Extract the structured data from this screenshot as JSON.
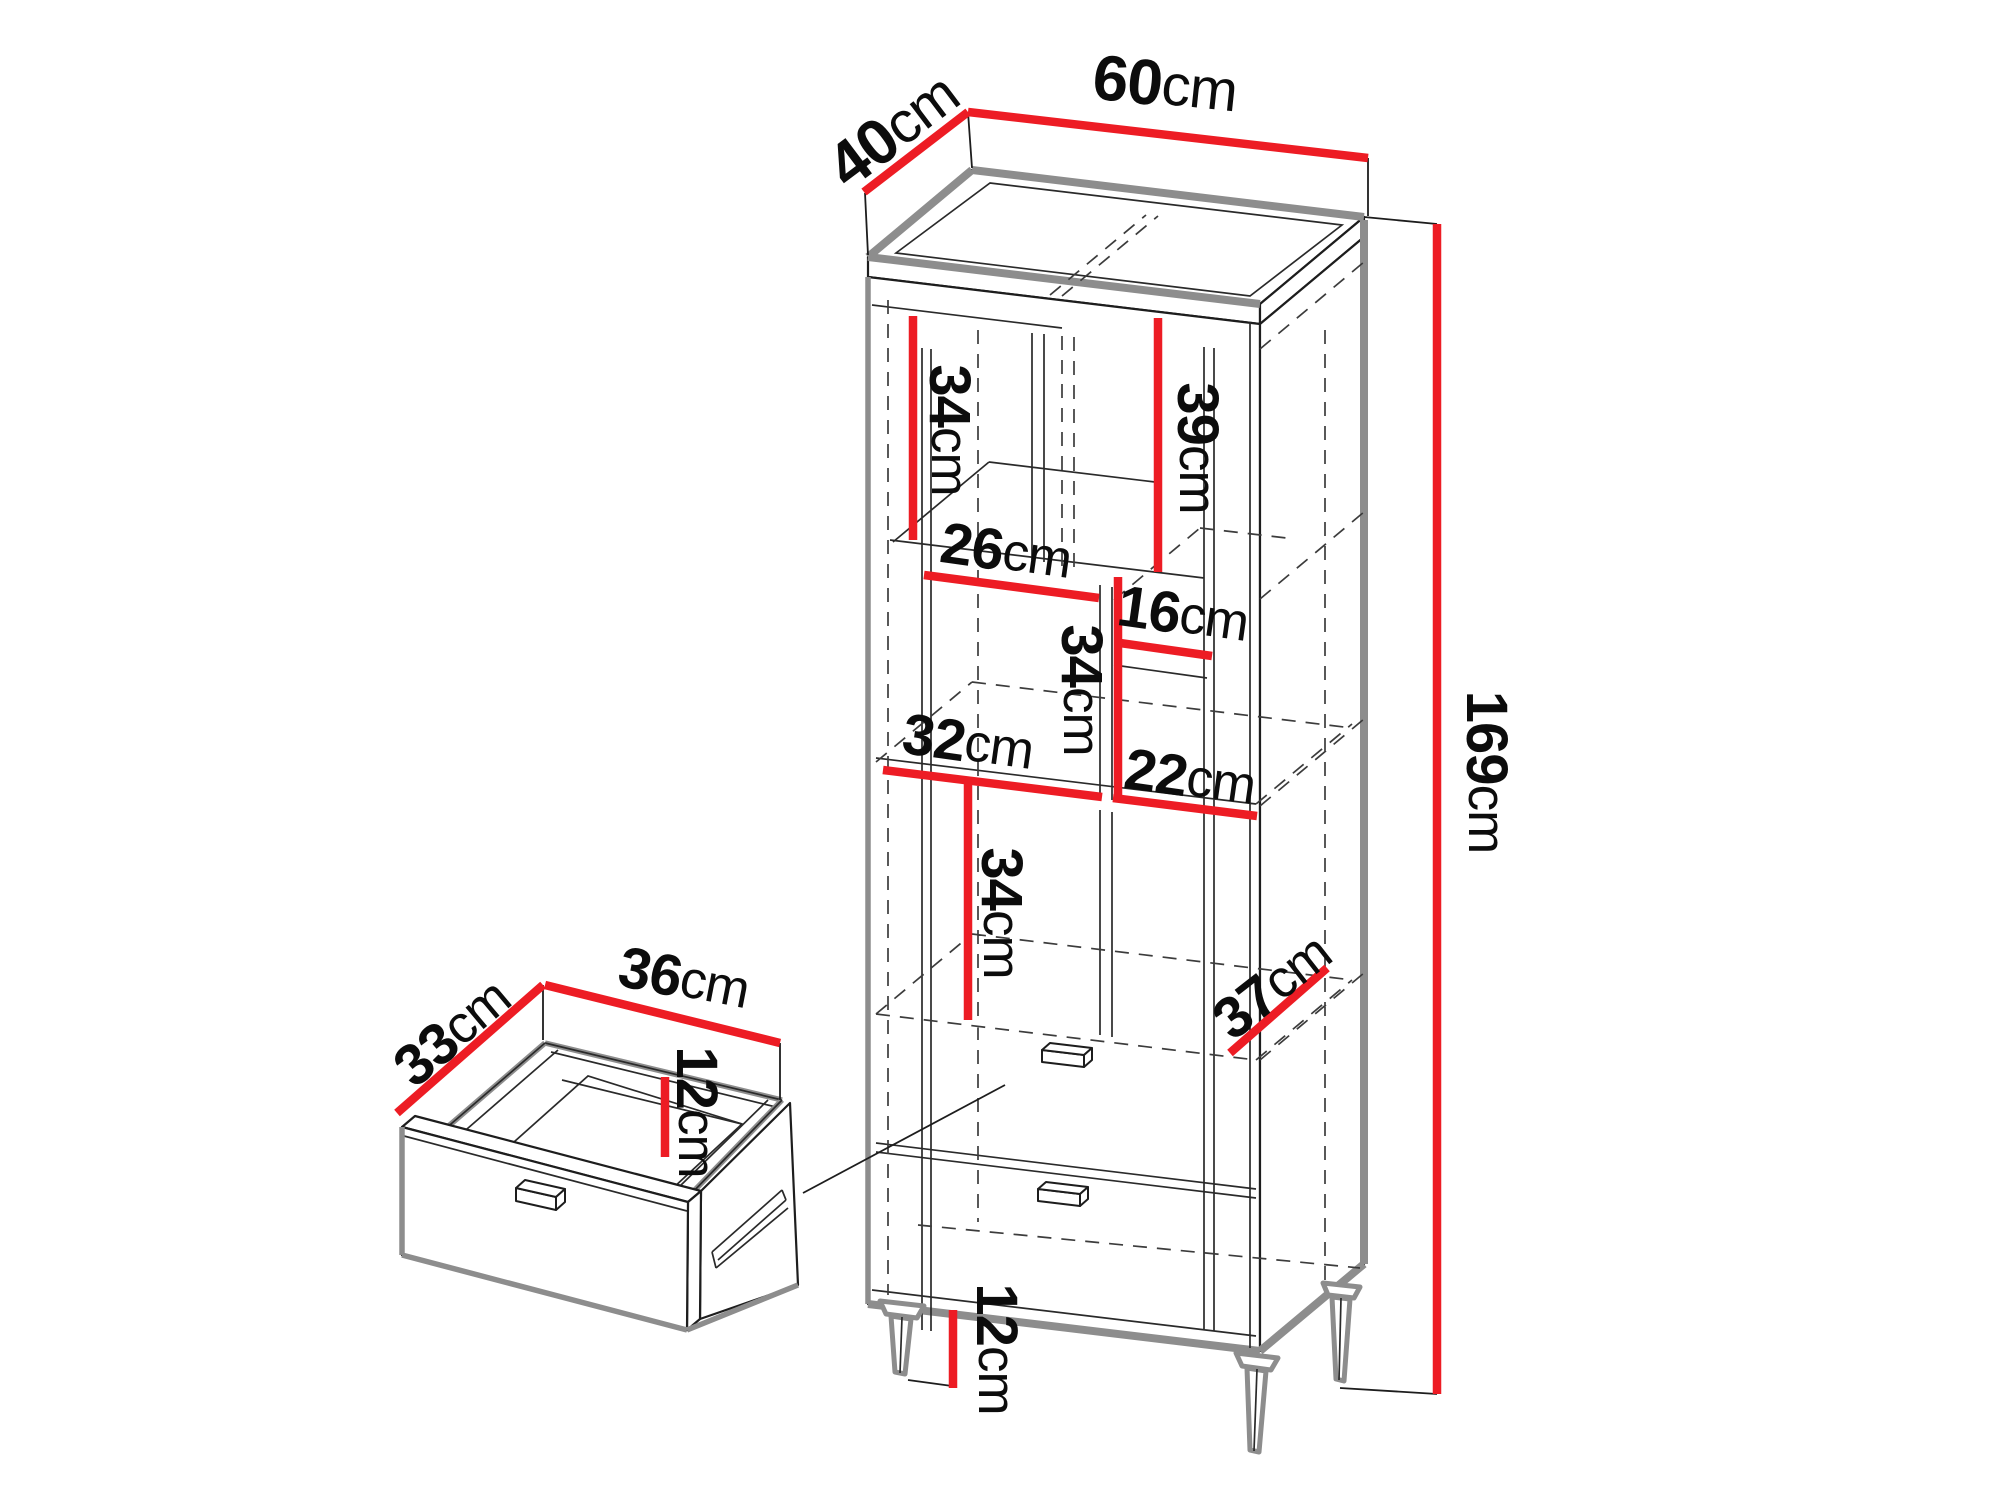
{
  "colors": {
    "dimension_red": "#ed1c24",
    "edge_gray": "#8d8d8d",
    "line_black": "#1d1d1d",
    "background": "#ffffff"
  },
  "cabinet": {
    "dims": {
      "top_depth": {
        "value": "40",
        "unit": "cm"
      },
      "top_width": {
        "value": "60",
        "unit": "cm"
      },
      "total_height": {
        "value": "169",
        "unit": "cm"
      },
      "upper_left_height": {
        "value": "34",
        "unit": "cm"
      },
      "upper_right_height": {
        "value": "39",
        "unit": "cm"
      },
      "upper_shelf_width": {
        "value": "26",
        "unit": "cm"
      },
      "right_small_height": {
        "value": "16",
        "unit": "cm"
      },
      "middle_height": {
        "value": "34",
        "unit": "cm"
      },
      "middle_left_width": {
        "value": "32",
        "unit": "cm"
      },
      "middle_right_width": {
        "value": "22",
        "unit": "cm"
      },
      "lower_height": {
        "value": "34",
        "unit": "cm"
      },
      "niche_depth": {
        "value": "37",
        "unit": "cm"
      },
      "leg_height": {
        "value": "12",
        "unit": "cm"
      }
    }
  },
  "drawer": {
    "dims": {
      "depth": {
        "value": "33",
        "unit": "cm"
      },
      "width": {
        "value": "36",
        "unit": "cm"
      },
      "height": {
        "value": "12",
        "unit": "cm"
      }
    }
  }
}
